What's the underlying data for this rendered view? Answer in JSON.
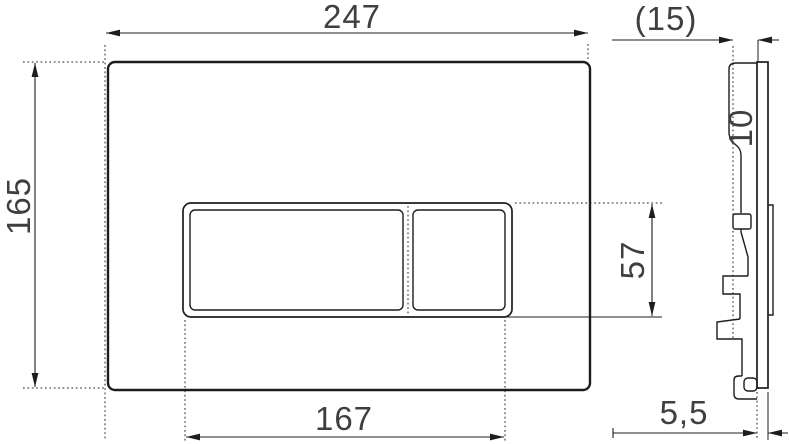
{
  "drawing": {
    "type": "technical-dimension-drawing",
    "colors": {
      "background": "#ffffff",
      "line": "#1d1d1b",
      "text": "#3f3f3f"
    },
    "dimensions": {
      "overall_width": "247",
      "overall_height": "165",
      "opening_width": "167",
      "opening_height": "57",
      "mounting_depth_ref": "(15)",
      "top_depth": "10",
      "plate_thickness": "5,5"
    }
  }
}
